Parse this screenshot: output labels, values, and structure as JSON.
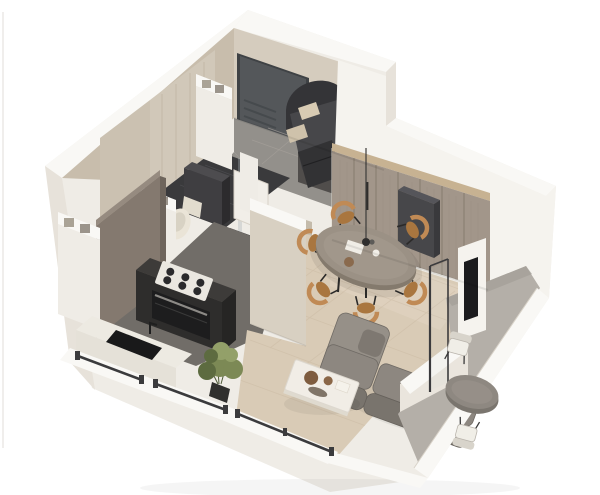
{
  "scene": {
    "type": "isometric_cutaway_floor_plan_render",
    "rooms": [
      {
        "id": "entry",
        "objects": [
          "front-door",
          "tile-floor",
          "dark-cabinet"
        ]
      },
      {
        "id": "bathroom",
        "objects": [
          "marble-wall",
          "toilet",
          "washing-machine",
          "shower-glass",
          "open-door"
        ]
      },
      {
        "id": "kitchen",
        "objects": [
          "tall-panel",
          "cooktop",
          "oven",
          "counter",
          "sink",
          "plant"
        ]
      },
      {
        "id": "bedroom",
        "objects": [
          "double-bed",
          "pillows",
          "foot-drawers"
        ]
      },
      {
        "id": "living-dining",
        "objects": [
          "wardrobe-wall",
          "pendant-lamp",
          "oval-dining-table",
          "six-wood-chairs",
          "sectional-sofa",
          "coffee-table",
          "wall-tv"
        ]
      },
      {
        "id": "balcony",
        "objects": [
          "sliding-door",
          "round-table",
          "two-chairs",
          "parapet"
        ]
      }
    ]
  },
  "palette": {
    "bg": "#ffffff",
    "photo_edge": "#e9e7e4",
    "wall_light": "#efece6",
    "wall_top": "#f9f8f5",
    "wall_bright": "#f5f3ee",
    "wall_mid": "#e7e2da",
    "wall_shade": "#d9d3c9",
    "beige_wall": "#d5ccbe",
    "beige_wall_dark": "#c8bdac",
    "marble_wall": "#d1c8b9",
    "marble_vein": "#b8ac99",
    "door_dark": "#54575a",
    "entry_floor": "#93908b",
    "entry_grout": "#a6a19b",
    "bath_floor": "#3a3a3c",
    "appliance_dark": "#3f3e41",
    "toilet_white": "#eae4d7",
    "wood_wall": "#a2968a",
    "wood_seam": "#837869",
    "wood_top": "#c7b292",
    "taupe_panel": "#84796f",
    "taupe_top": "#968b80",
    "kitchen_floor": "#716d68",
    "counter_dark": "#3d3b39",
    "cabinet_dark": "#2e2d2c",
    "hob_white": "#eae7e0",
    "burner_dark": "#2a2a2c",
    "oven_black": "#1d1d1e",
    "white_counter": "#edeae2",
    "sink_black": "#19191a",
    "half_wall": "#d8d0c2",
    "living_floor": "#d9cbb6",
    "floor_line": "#c6b59d",
    "floor_light": "#e2d6c3",
    "table_stone": "#9b9185",
    "table_side": "#847a6d",
    "chair_wood": "#c08a55",
    "chair_seat": "#a9763f",
    "leg_dark": "#2b2a29",
    "sofa_gray": "#8d8780",
    "sofa_dark": "#79746d",
    "sofa_light": "#969088",
    "coffee_white": "#f1ede6",
    "decor_brown": "#7e5c3f",
    "plant_green": "#7c8955",
    "plant_dark": "#5d6b40",
    "pot_dark": "#30302e",
    "balcony_floor": "#b4afa8",
    "balcony_table": "#8e8881",
    "cushion_white": "#f0eee7",
    "frame_dark": "#3b3b3d",
    "tv_black": "#1b1b1d",
    "bed_dark": "#47474a",
    "bed_darker": "#343437",
    "pillow_beige": "#d8cbb3",
    "shadow": "#000000"
  }
}
